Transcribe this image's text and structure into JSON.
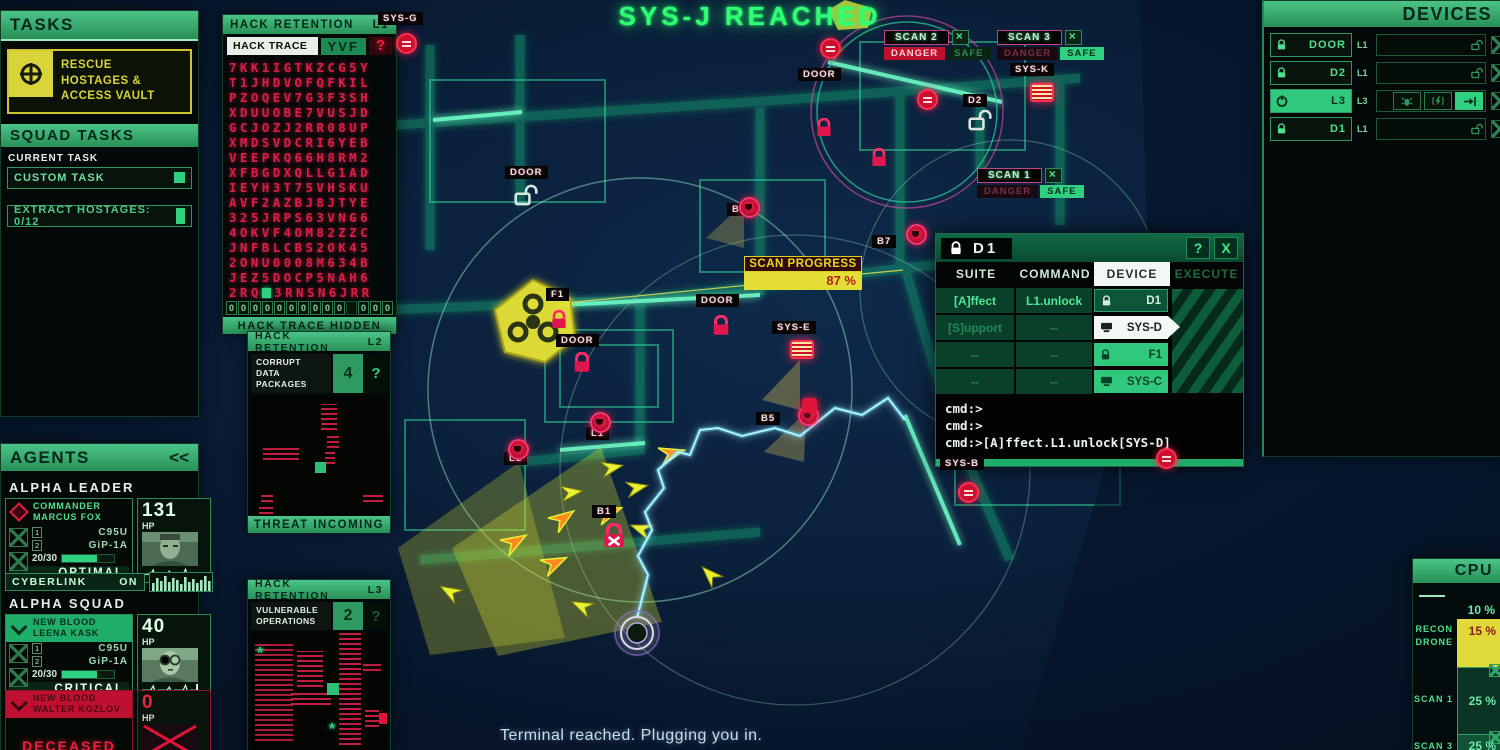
{
  "title": "SYS-J REACHED",
  "status_message": "Terminal reached. Plugging you in.",
  "tasks": {
    "header": "TASKS",
    "main_task": "RESCUE HOSTAGES & ACCESS VAULT",
    "squad_header": "SQUAD TASKS",
    "current_task_label": "CURRENT TASK",
    "current_task_value": "CUSTOM TASK",
    "progress_task": "EXTRACT HOSTAGES: 0/12"
  },
  "hack_l1": {
    "header": "HACK RETENTION",
    "level": "L1",
    "trace_label": "HACK TRACE",
    "trace_value": "YVF",
    "help": "?",
    "rows": [
      "7KK1IGTKZCG5Y",
      "T1JHDVOFQFKIL",
      "PZOQEV7G3F3SH",
      "XDUUOBE7VUSJD",
      "GCJOZJ2RR08UP",
      "XMDSVDCRI6YEB",
      "VEEPKQ66H8RM2",
      "XFBGDXQLLG1AD",
      "IEYH3T75VHSKU",
      "AVF2AZBJ8JTYE",
      "325JRPS63VNG6",
      "4OKVF4OM82ZZC",
      "JNFBLCBS2OK45",
      "2ONU0008M634B",
      "JEZ5DOCP5NAH6",
      {
        "pre": "2RQ",
        "post": "3RNSN6JRR"
      },
      "S1P4IDFPEJD58",
      "QN***21E50X88",
      "5YJRD8475H72C"
    ],
    "slots": [
      "0",
      "0",
      "0",
      "0",
      "0",
      "0",
      "0",
      "0",
      "0",
      "0",
      "",
      "0",
      "0",
      "0"
    ],
    "footer": "HACK TRACE HIDDEN"
  },
  "hack_l2": {
    "header": "HACK RETENTION",
    "level": "L2",
    "label": "CORRUPT DATA PACKAGES",
    "count": "4",
    "help": "?",
    "footer": "THREAT INCOMING"
  },
  "hack_l3": {
    "header": "HACK RETENTION",
    "level": "L3",
    "label": "VULNERABLE OPERATIONS",
    "count": "2",
    "help": "?",
    "markers": [
      "*",
      "*"
    ]
  },
  "agents": {
    "header": "AGENTS",
    "collapse": "<<",
    "leader_label": "ALPHA LEADER",
    "squad_label": "ALPHA SQUAD",
    "cyberlink_label": "CYBERLINK",
    "cyberlink_state": "ON",
    "hp_label": "HP",
    "leader": {
      "rank": "COMMANDER",
      "name": "MARCUS FOX",
      "slot1": "1",
      "slot2": "2",
      "weapon1": "C95U",
      "weapon2": "GiP-1A",
      "ammo": "20/30",
      "status": "OPTIMAL",
      "hp": "131"
    },
    "squad1": {
      "rank": "NEW BLOOD",
      "name": "LEENA KASK",
      "slot1": "1",
      "slot2": "2",
      "weapon1": "C95U",
      "weapon2": "GiP-1A",
      "ammo": "20/30",
      "status": "CRITICAL",
      "hp": "40"
    },
    "squad2": {
      "rank": "NEW BLOOD",
      "name": "WALTER KOZLOV",
      "status": "DECEASED",
      "hp": "0"
    }
  },
  "devices": {
    "header": "DEVICES",
    "rows": [
      {
        "name": "DOOR",
        "level": "L1"
      },
      {
        "name": "D2",
        "level": "L1"
      },
      {
        "name": "L3",
        "level": "L3"
      },
      {
        "name": "D1",
        "level": "L1"
      }
    ]
  },
  "cpu": {
    "header": "CPU",
    "idle_value": "10 %",
    "rows": [
      {
        "label": "RECON DRONE",
        "value": "15 %"
      },
      {
        "label": "SCAN 1",
        "value": "25 %"
      },
      {
        "label": "SCAN 3",
        "value": "25 %"
      }
    ]
  },
  "dialog": {
    "title": "D1",
    "help": "?",
    "close": "X",
    "tabs": [
      "SUITE",
      "COMMAND",
      "DEVICE",
      "EXECUTE"
    ],
    "suite": [
      "[A]ffect",
      "[S]upport",
      "--",
      "--"
    ],
    "command": [
      "L1.unlock",
      "--",
      "--",
      "--"
    ],
    "devices": [
      "D1",
      "SYS-D",
      "F1",
      "SYS-C"
    ],
    "terminal": [
      "cmd:>",
      "cmd:>",
      "cmd:>[A]ffect.L1.unlock[SYS-D]"
    ]
  },
  "scan_progress": {
    "label": "SCAN PROGRESS",
    "value": "87 %"
  },
  "markers": {
    "scan1": {
      "label": "SCAN 1",
      "danger": "DANGER",
      "safe": "SAFE"
    },
    "scan2": {
      "label": "SCAN 2",
      "danger": "DANGER",
      "safe": "SAFE"
    },
    "scan3": {
      "label": "SCAN 3",
      "danger": "DANGER",
      "safe": "SAFE"
    }
  },
  "map_labels": [
    "SYS-G",
    "SYS-K",
    "D2",
    "DOOR",
    "B5",
    "B7",
    "DOOR",
    "SYS-E",
    "F1",
    "DOOR",
    "B5",
    "L1",
    "L1",
    "B1",
    "SYS-B",
    "DOOR"
  ]
}
